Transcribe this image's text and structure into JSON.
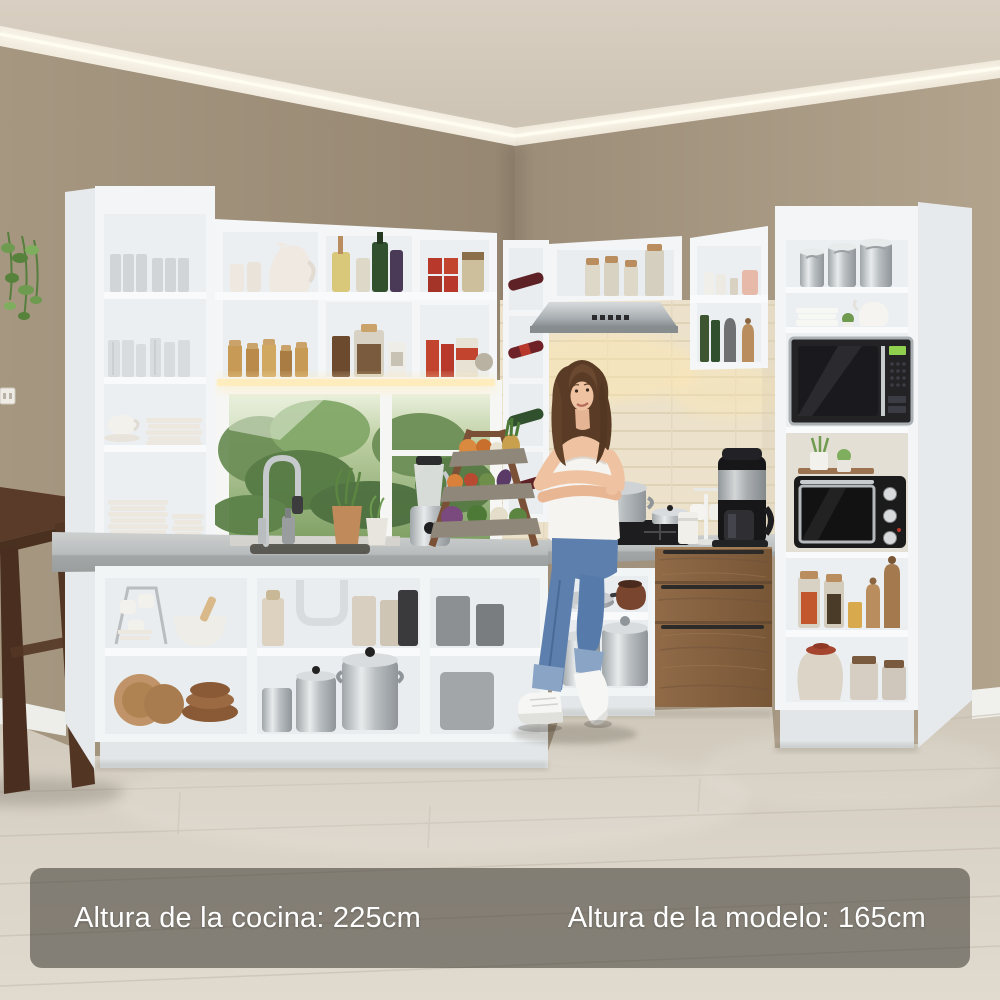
{
  "captions": {
    "kitchen_height": "Altura de la cocina: 225cm",
    "model_height": "Altura de la modelo: 165cm"
  },
  "palette": {
    "wall_left": "#a29379",
    "wall_right": "#ad9e88",
    "ceiling": "#d4cabc",
    "cabinet_white": "#f3f5f6",
    "cabinet_interior": "#eceff1",
    "countertop": "#c2c6c6",
    "wood_drawers": "#8a6546",
    "floor": "#d8d1c5",
    "backsplash_tile": "#f0e9d6",
    "warm_light": "#ffedbb",
    "banner_background": "rgba(58,54,48,0.55)",
    "banner_text": "#ffffff",
    "jeans": "#5d7fae",
    "hair": "#5a3c26",
    "skin": "#efc3a2"
  },
  "scene": {
    "left_unit": [
      "tall-open-shelf-with-glasses-and-plates",
      "upper-cabinets-with-pitcher-jars-oils-cans",
      "window-with-garden-view",
      "sink-with-gooseneck-faucet",
      "base-open-shelves-with-cups-mortar-pots"
    ],
    "center": [
      "corner-wine-rack",
      "range-hood",
      "gas-cooktop-with-steel-pot",
      "cream-tiled-backsplash"
    ],
    "right_unit": [
      "upper-cabinet-with-shakers-and-oil-bottles",
      "pantry-column-with-canisters-microwave-mini-oven-jars",
      "three-drawer-wood-chest",
      "open-base-shelf-with-pans-and-stockpots"
    ],
    "props": [
      "standing-model",
      "tiered-produce-rack",
      "blender",
      "coffee-maker",
      "mug-tree",
      "hanging-plant",
      "wooden-chair"
    ]
  }
}
